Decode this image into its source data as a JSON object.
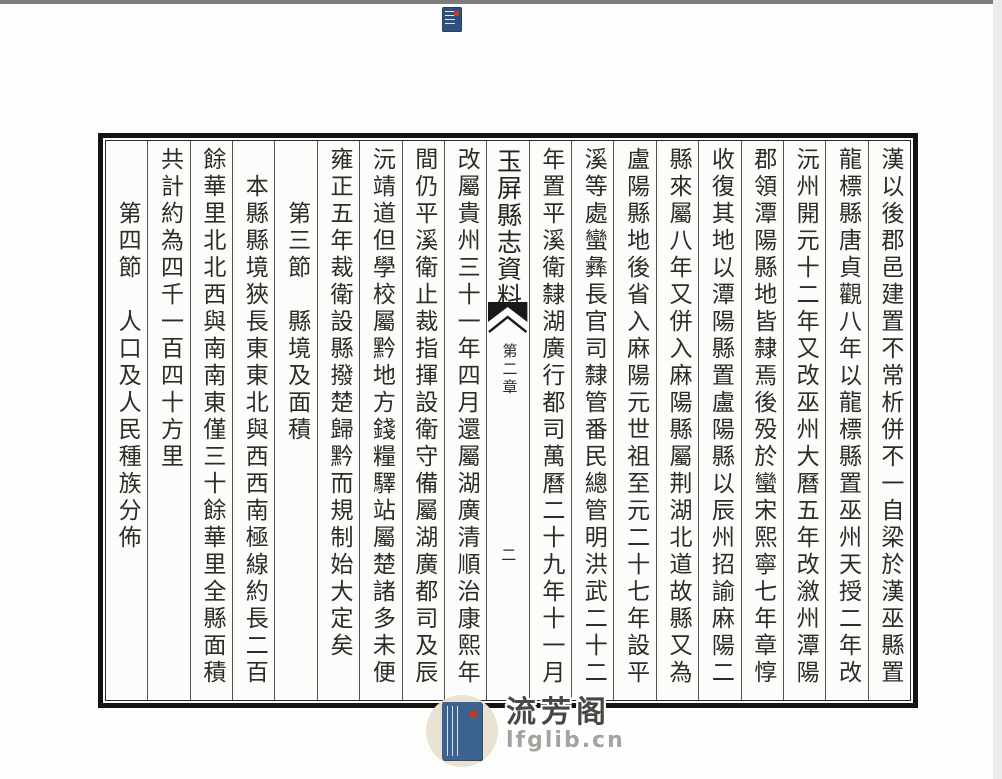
{
  "page": {
    "columns": [
      {
        "type": "text",
        "text": "漢以後郡邑建置不常析併不一自梁於漢巫縣置"
      },
      {
        "type": "text",
        "text": "龍標縣唐貞觀八年以龍標縣置巫州天授二年改"
      },
      {
        "type": "text",
        "text": "沅州開元十二年又改巫州大曆五年改漵州潭陽"
      },
      {
        "type": "text",
        "text": "郡領潭陽縣地皆隸焉後殁於蠻宋熙寧七年章惇"
      },
      {
        "type": "text",
        "text": "收復其地以潭陽縣置盧陽縣以辰州招諭麻陽二"
      },
      {
        "type": "text",
        "text": "縣來屬八年又併入麻陽縣屬荆湖北道故縣又為"
      },
      {
        "type": "text",
        "text": "盧陽縣地後省入麻陽元世祖至元二十七年設平"
      },
      {
        "type": "text",
        "text": "溪等處蠻彝長官司隸管番民總管明洪武二十二"
      },
      {
        "type": "text",
        "text": "年置平溪衛隸湖廣行都司萬曆二十九年十一月"
      },
      {
        "type": "divider"
      },
      {
        "type": "text",
        "text": "改屬貴州三十一年四月還屬湖廣清順治康熙年"
      },
      {
        "type": "text",
        "text": "間仍平溪衛止裁指揮設衛守備屬湖廣都司及辰"
      },
      {
        "type": "text",
        "text": "沅靖道但學校屬黔地方錢糧驛站屬楚諸多未便"
      },
      {
        "type": "text",
        "text": "雍正五年裁衛設縣撥楚歸黔而規制始大定矣"
      },
      {
        "type": "text",
        "text": "　　第三節　縣境及面積"
      },
      {
        "type": "text",
        "text": "　本縣縣境狹長東東北與西西南極線約長二百"
      },
      {
        "type": "text",
        "text": "餘華里北北西與南南東僅三十餘華里全縣面積"
      },
      {
        "type": "text",
        "text": "共計約為四千一百四十方里"
      },
      {
        "type": "text",
        "text": "　　第四節　人口及人民種族分佈"
      }
    ],
    "divider": {
      "title": "玉屏縣志資料",
      "chapter": "第二章",
      "page_number": "二"
    }
  },
  "watermark": {
    "site_name": "流芳阁",
    "site_url": "lfglib.cn"
  },
  "icons": {
    "favicon": "book-logo-icon",
    "badge": "watermark-book-icon",
    "fishtail": "fishtail-mark-icon"
  },
  "colors": {
    "frame_border": "#141414",
    "ink": "#2e2c29",
    "book_blue": "#3c6290",
    "seal_red": "#c0392b",
    "badge_beige": "#e9e1d2"
  }
}
